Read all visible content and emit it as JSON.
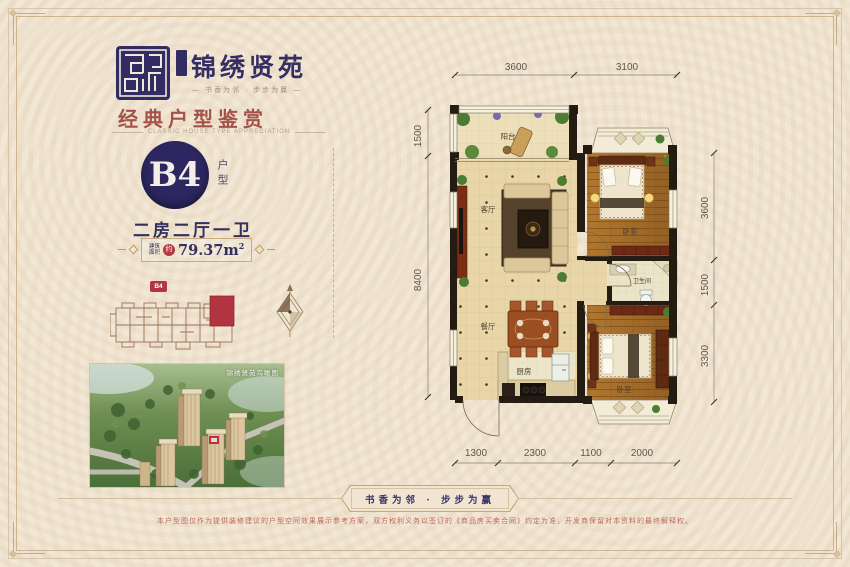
{
  "colors": {
    "background": "#f0e4d0",
    "navy_accent": "#2c2760",
    "maroon_title": "#a4524a",
    "red_accent": "#b23440",
    "frame_line": "#ccb491"
  },
  "brand": {
    "name": "锦绣贤苑",
    "tagline": "— 书香为邻 · 步步为赢 —",
    "seal_icon": "brand-seal-icon"
  },
  "section": {
    "title": "经典户型鉴赏",
    "subtitle": "CLASSIC HOUSE TYPE APPRECIATION"
  },
  "unit": {
    "code": "B4",
    "code_label": "户型",
    "layout": "二房二厅一卫",
    "area_label_1": "建筑",
    "area_label_2": "面积",
    "area_approx": "约",
    "area_value": "79.37m",
    "area_sup": "2"
  },
  "locator": {
    "tag": "B4"
  },
  "aerial": {
    "caption": "锦绣贤苑鸟瞰图"
  },
  "floorplan": {
    "rooms": {
      "balcony": "阳台",
      "living": "客厅",
      "bedroom1": "卧室",
      "bath": "卫生间",
      "dining": "餐厅",
      "kitchen": "厨房",
      "bedroom2": "卧室"
    },
    "dims": {
      "top": [
        "3600",
        "3100"
      ],
      "left": [
        "1500",
        "8400"
      ],
      "right": [
        "3600",
        "1500",
        "3300"
      ],
      "bottom": [
        "1300",
        "2300",
        "1100",
        "2000"
      ]
    }
  },
  "footer": {
    "slogan": "书香为邻 · 步步为赢",
    "disclaimer": "本户型图仅作为提供装修建议的户型空间效果展示参考方案，双方权利义务以签订的《商品房买卖合同》约定为准，开发商保留对本资料的最终解释权。"
  }
}
